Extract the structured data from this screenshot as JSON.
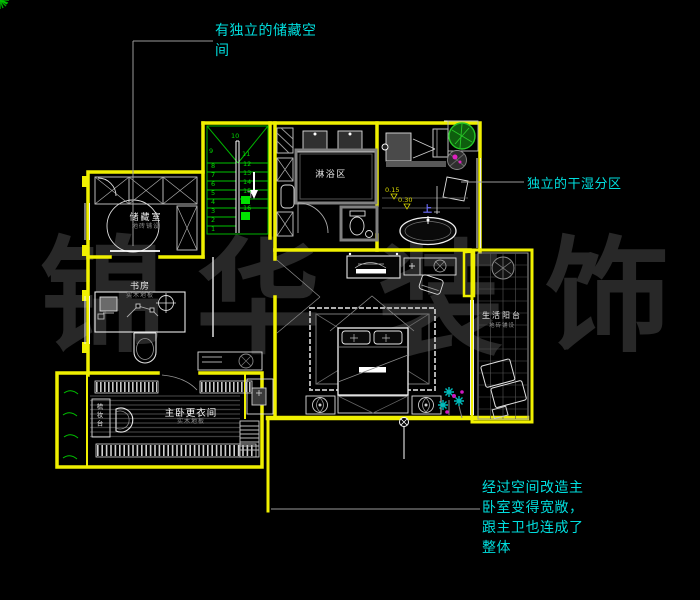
{
  "watermark": {
    "text": "锦华装饰",
    "chars": [
      "锦",
      "华",
      "装",
      "饰"
    ],
    "color": "#282828"
  },
  "annotations": {
    "storage_note": "有独立的储藏空间",
    "dry_wet_note": "独立的干湿分区",
    "master_note": "经过空间改造主卧室变得宽敞，跟主卫也连成了整体",
    "color": "#00dede"
  },
  "rooms": {
    "storage": {
      "name": "储藏室",
      "finish": "地砖铺设"
    },
    "study": {
      "name": "书房",
      "finish": "实木地板"
    },
    "shower": {
      "name": "淋浴区"
    },
    "balcony": {
      "name": "生活阳台",
      "finish": "地砖铺设"
    },
    "dressing": {
      "name": "主卧更衣间",
      "finish": "实木地板"
    },
    "vanity": {
      "name": "梳妆台"
    }
  },
  "stairs": {
    "down_label": "下",
    "numbers": [
      "1",
      "2",
      "3",
      "4",
      "5",
      "6",
      "7",
      "8",
      "9",
      "10",
      "11",
      "12",
      "13",
      "14",
      "15",
      "16"
    ]
  },
  "levels": {
    "up_label": "上",
    "v1": "0.15",
    "v2": "0.30"
  },
  "colors": {
    "wall": "#f0f000",
    "stair": "#00b400",
    "annotation": "#00dede",
    "background": "#000000"
  }
}
